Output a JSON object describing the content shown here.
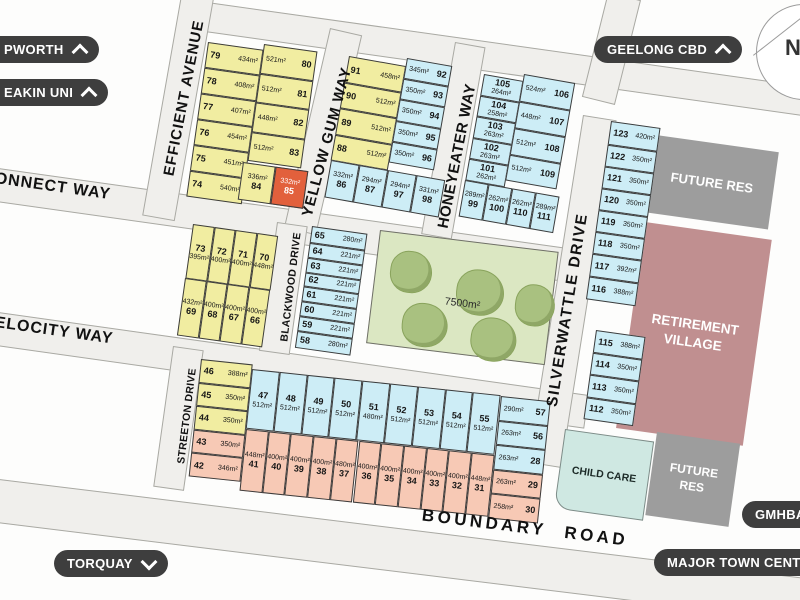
{
  "pills": {
    "epworth": {
      "label": "PWORTH",
      "direction": "up"
    },
    "deakin": {
      "label": "EAKIN UNI",
      "direction": "up"
    },
    "geelong_cbd": {
      "label": "GEELONG CBD",
      "direction": "up"
    },
    "torquay": {
      "label": "TORQUAY",
      "direction": "down"
    },
    "gmhba": {
      "label": "GMHBA",
      "direction": "none"
    },
    "major_town_centre": {
      "label": "MAJOR TOWN CENT",
      "direction": "none"
    }
  },
  "compass": {
    "label": "N"
  },
  "streets": {
    "efficient": "EFFICIENT  AVENUE",
    "yellow_gum": "YELLOW GUM WAY",
    "honeyeater": "HONEYEATER  WAY",
    "silverwattle": "SILVERWATTLE  DRIVE",
    "blackwood": "BLACKWOOD DRIVE",
    "streeton": "STREETON DRIVE",
    "connect": "ONNECT WAY",
    "velocity": "ELOCITY WAY",
    "boundary": "BOUNDARY  ROAD"
  },
  "park": {
    "area_label": "7500m²"
  },
  "features": {
    "child_care": "CHILD CARE",
    "future_res_top": "FUTURE RES",
    "future_res_bottom": "FUTURE RES",
    "retirement_village": "RETIREMENT VILLAGE"
  },
  "colors": {
    "lot_yellow": "#f1eda1",
    "lot_blue": "#cdedf6",
    "lot_salmon": "#f7c9b5",
    "lot_orange": "#e2603c",
    "park_green": "#dbe7c2",
    "tree_green": "#a9c180",
    "road_fill": "#f0efec",
    "retirement": "#c08f90",
    "future_res": "#9d9d9d",
    "child_care": "#cfe8e2",
    "pill_dark": "#3e3e3e"
  },
  "lots": {
    "block_a_west": [
      {
        "n": "79",
        "a": "434m²"
      },
      {
        "n": "78",
        "a": "408m²"
      },
      {
        "n": "77",
        "a": "407m²"
      },
      {
        "n": "76",
        "a": "454m²"
      },
      {
        "n": "75",
        "a": "451m²"
      },
      {
        "n": "74",
        "a": "540m²"
      }
    ],
    "block_a_east": [
      {
        "n": "80",
        "a": "521m²"
      },
      {
        "n": "81",
        "a": "512m²"
      },
      {
        "n": "82",
        "a": "448m²"
      },
      {
        "n": "83",
        "a": "512m²"
      }
    ],
    "block_a_bottom": [
      {
        "n": "84",
        "a": "336m²"
      },
      {
        "n": "85",
        "a": "332m²",
        "c": "o"
      }
    ],
    "block_b_yellow": [
      {
        "n": "91",
        "a": "458m²"
      },
      {
        "n": "90",
        "a": "512m²"
      },
      {
        "n": "89",
        "a": "512m²"
      },
      {
        "n": "88",
        "a": "512m²"
      }
    ],
    "block_b_blue": [
      {
        "n": "92",
        "a": "345m²"
      },
      {
        "n": "93",
        "a": "350m²"
      },
      {
        "n": "94",
        "a": "350m²"
      },
      {
        "n": "95",
        "a": "350m²"
      },
      {
        "n": "96",
        "a": "350m²"
      }
    ],
    "block_b_bottom": [
      {
        "n": "86",
        "a": "332m²"
      },
      {
        "n": "87",
        "a": "294m²"
      },
      {
        "n": "97",
        "a": "294m²"
      },
      {
        "n": "98",
        "a": "331m²"
      }
    ],
    "block_c_left": [
      {
        "n": "105",
        "a": "264m²"
      },
      {
        "n": "104",
        "a": "258m²"
      },
      {
        "n": "103",
        "a": "263m²"
      },
      {
        "n": "102",
        "a": "263m²"
      },
      {
        "n": "101",
        "a": "262m²"
      }
    ],
    "block_c_right": [
      {
        "n": "106",
        "a": "524m²"
      },
      {
        "n": "107",
        "a": "448m²"
      },
      {
        "n": "108",
        "a": "512m²"
      },
      {
        "n": "109",
        "a": "512m²"
      }
    ],
    "block_c_bottom": [
      {
        "n": "99",
        "a": "289m²"
      },
      {
        "n": "100",
        "a": "262m²"
      },
      {
        "n": "110",
        "a": "262m²"
      },
      {
        "n": "111",
        "a": "289m²"
      }
    ],
    "block_d_top": [
      {
        "n": "123",
        "a": "420m²"
      },
      {
        "n": "122",
        "a": "350m²"
      },
      {
        "n": "121",
        "a": "350m²"
      },
      {
        "n": "120",
        "a": "350m²"
      },
      {
        "n": "119",
        "a": "350m²"
      },
      {
        "n": "118",
        "a": "350m²"
      },
      {
        "n": "117",
        "a": "392m²"
      },
      {
        "n": "116",
        "a": "388m²"
      }
    ],
    "block_d_bottom": [
      {
        "n": "115",
        "a": "388m²"
      },
      {
        "n": "114",
        "a": "350m²"
      },
      {
        "n": "113",
        "a": "350m²"
      },
      {
        "n": "112",
        "a": "350m²"
      }
    ],
    "block_e_top": [
      {
        "n": "73",
        "a": "395m²"
      },
      {
        "n": "72",
        "a": "400m²"
      },
      {
        "n": "71",
        "a": "400m²"
      },
      {
        "n": "70",
        "a": "448m²"
      }
    ],
    "block_e_bottom": [
      {
        "n": "69",
        "a": "432m²"
      },
      {
        "n": "68",
        "a": "400m²"
      },
      {
        "n": "67",
        "a": "400m²"
      },
      {
        "n": "66",
        "a": "400m²"
      }
    ],
    "block_f": [
      {
        "n": "65",
        "a": "280m²"
      },
      {
        "n": "64",
        "a": "221m²"
      },
      {
        "n": "63",
        "a": "221m²"
      },
      {
        "n": "62",
        "a": "221m²"
      },
      {
        "n": "61",
        "a": "221m²"
      },
      {
        "n": "60",
        "a": "221m²"
      },
      {
        "n": "59",
        "a": "221m²"
      },
      {
        "n": "58",
        "a": "280m²"
      }
    ],
    "block_g_west": [
      {
        "n": "46",
        "a": "388m²",
        "c": "y"
      },
      {
        "n": "45",
        "a": "350m²",
        "c": "y"
      },
      {
        "n": "44",
        "a": "350m²",
        "c": "y"
      },
      {
        "n": "43",
        "a": "350m²",
        "c": "s"
      },
      {
        "n": "42",
        "a": "346m²",
        "c": "s"
      }
    ],
    "block_g_blue": [
      {
        "n": "47",
        "a": "512m²"
      },
      {
        "n": "48",
        "a": "512m²"
      },
      {
        "n": "49",
        "a": "512m²"
      },
      {
        "n": "50",
        "a": "512m²"
      },
      {
        "n": "51",
        "a": "480m²"
      },
      {
        "n": "52",
        "a": "512m²"
      },
      {
        "n": "53",
        "a": "512m²"
      },
      {
        "n": "54",
        "a": "512m²"
      },
      {
        "n": "55",
        "a": "512m²"
      }
    ],
    "block_g_salmon": [
      {
        "n": "41",
        "a": "448m²"
      },
      {
        "n": "40",
        "a": "400m²"
      },
      {
        "n": "39",
        "a": "400m²"
      },
      {
        "n": "38",
        "a": "400m²"
      },
      {
        "n": "37",
        "a": "480m²"
      },
      {
        "n": "36",
        "a": "400m²"
      },
      {
        "n": "35",
        "a": "400m²"
      },
      {
        "n": "34",
        "a": "400m²"
      },
      {
        "n": "33",
        "a": "400m²"
      },
      {
        "n": "32",
        "a": "400m²"
      },
      {
        "n": "31",
        "a": "448m²"
      }
    ],
    "block_g_right": [
      {
        "n": "57",
        "a": "290m²",
        "c": "b"
      },
      {
        "n": "56",
        "a": "263m²",
        "c": "b"
      },
      {
        "n": "28",
        "a": "263m²",
        "c": "b"
      },
      {
        "n": "29",
        "a": "263m²",
        "c": "s"
      },
      {
        "n": "30",
        "a": "258m²",
        "c": "s"
      }
    ]
  }
}
